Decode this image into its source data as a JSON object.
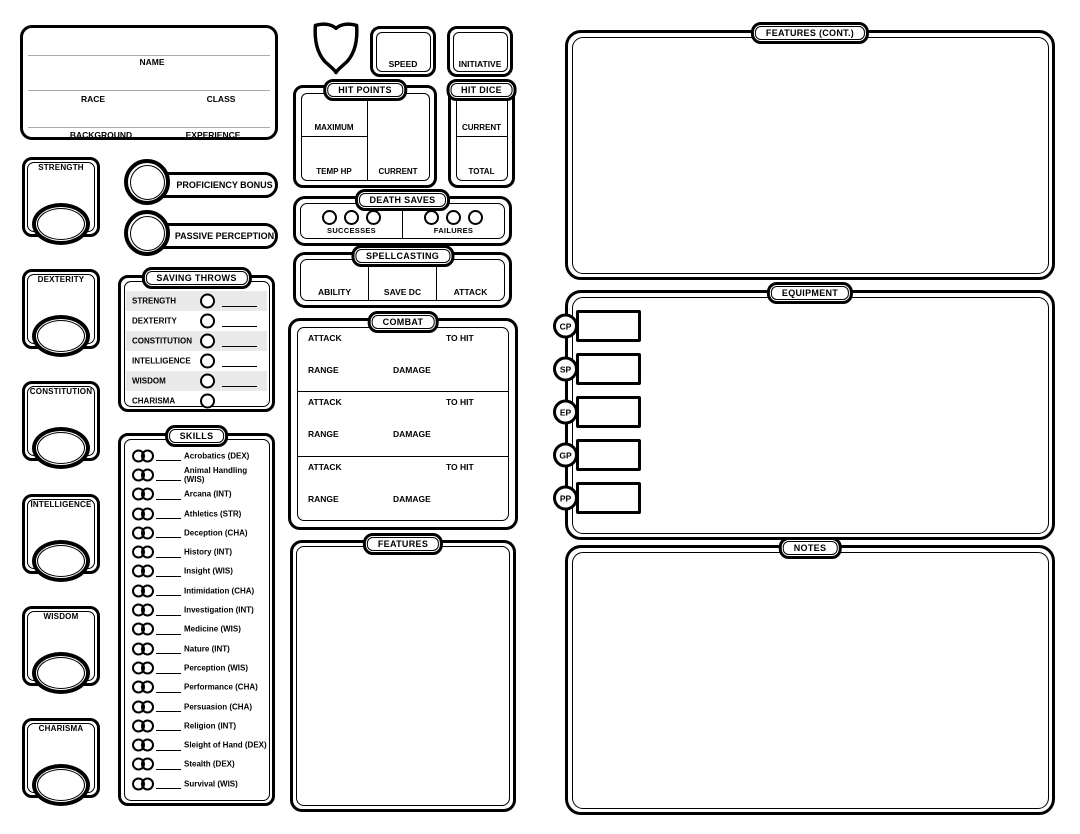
{
  "colors": {
    "ink": "#000000",
    "paper": "#ffffff",
    "row_stripe": "#e9e9e9",
    "rule_line": "#aaaaaa"
  },
  "identity": {
    "name_label": "NAME",
    "race_label": "RACE",
    "class_label": "CLASS",
    "background_label": "BACKGROUND",
    "experience_label": "EXPERIENCE"
  },
  "abilities": [
    "STRENGTH",
    "DEXTERITY",
    "CONSTITUTION",
    "INTELLIGENCE",
    "WISDOM",
    "CHARISMA"
  ],
  "proficiency_bonus_label": "PROFICIENCY BONUS",
  "passive_perception_label": "PASSIVE PERCEPTION",
  "saving_throws": {
    "title": "SAVING THROWS",
    "abilities": [
      "STRENGTH",
      "DEXTERITY",
      "CONSTITUTION",
      "INTELLIGENCE",
      "WISDOM",
      "CHARISMA"
    ]
  },
  "skills": {
    "title": "SKILLS",
    "items": [
      "Acrobatics (DEX)",
      "Animal Handling (WIS)",
      "Arcana (INT)",
      "Athletics (STR)",
      "Deception (CHA)",
      "History (INT)",
      "Insight (WIS)",
      "Intimidation (CHA)",
      "Investigation (INT)",
      "Medicine (WIS)",
      "Nature (INT)",
      "Perception (WIS)",
      "Performance (CHA)",
      "Persuasion (CHA)",
      "Religion (INT)",
      "Sleight of Hand (DEX)",
      "Stealth (DEX)",
      "Survival (WIS)"
    ]
  },
  "armor_class": {
    "icon": "shield-icon"
  },
  "speed": {
    "label": "SPEED"
  },
  "initiative": {
    "label": "INITIATIVE"
  },
  "hit_points": {
    "title": "HIT POINTS",
    "maximum_label": "MAXIMUM",
    "temp_hp_label": "TEMP HP",
    "current_label": "CURRENT"
  },
  "hit_dice": {
    "title": "HIT DICE",
    "current_label": "CURRENT",
    "total_label": "TOTAL"
  },
  "death_saves": {
    "title": "DEATH SAVES",
    "successes_label": "SUCCESSES",
    "failures_label": "FAILURES"
  },
  "spellcasting": {
    "title": "SPELLCASTING",
    "cells": [
      "ABILITY",
      "SAVE DC",
      "ATTACK"
    ]
  },
  "combat": {
    "title": "COMBAT",
    "rows": [
      {
        "attack_label": "ATTACK",
        "to_hit_label": "TO HIT",
        "range_label": "RANGE",
        "damage_label": "DAMAGE"
      },
      {
        "attack_label": "ATTACK",
        "to_hit_label": "TO HIT",
        "range_label": "RANGE",
        "damage_label": "DAMAGE"
      },
      {
        "attack_label": "ATTACK",
        "to_hit_label": "TO HIT",
        "range_label": "RANGE",
        "damage_label": "DAMAGE"
      }
    ]
  },
  "features": {
    "title": "FEATURES"
  },
  "features_cont": {
    "title": "FEATURES (CONT.)"
  },
  "equipment": {
    "title": "EQUIPMENT",
    "coins": [
      "CP",
      "SP",
      "EP",
      "GP",
      "PP"
    ]
  },
  "notes": {
    "title": "NOTES"
  }
}
